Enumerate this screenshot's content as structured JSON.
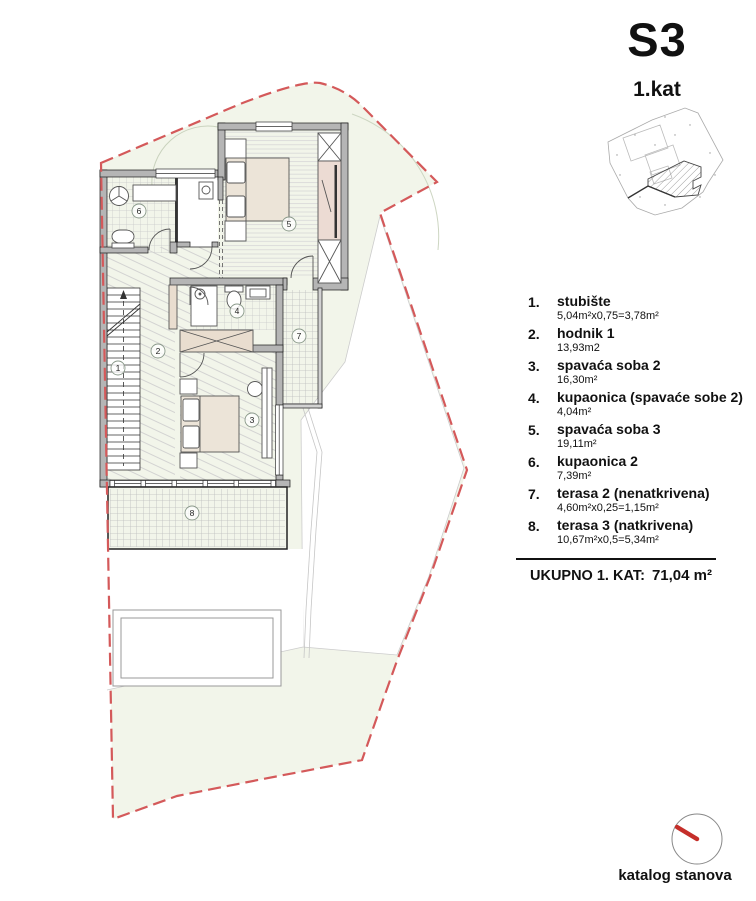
{
  "header": {
    "title": "S3",
    "subtitle": "1.kat"
  },
  "legend": {
    "items": [
      {
        "num": "1.",
        "name": "stubište",
        "area": "5,04m²x0,75=3,78m²"
      },
      {
        "num": "2.",
        "name": "hodnik 1",
        "area": "13,93m2"
      },
      {
        "num": "3.",
        "name": "spavaća soba 2",
        "area": "16,30m²"
      },
      {
        "num": "4.",
        "name": "kupaonica (spavaće sobe 2)",
        "area": "4,04m²"
      },
      {
        "num": "5.",
        "name": "spavaća soba 3",
        "area": "19,11m²"
      },
      {
        "num": "6.",
        "name": "kupaonica 2",
        "area": "7,39m²"
      },
      {
        "num": "7.",
        "name": "terasa 2 (nenatkrivena)",
        "area": "4,60m²x0,25=1,15m²"
      },
      {
        "num": "8.",
        "name": "terasa 3 (natkrivena)",
        "area": "10,67m²x0,5=5,34m²"
      }
    ],
    "total_label": "UKUPNO 1. KAT:",
    "total_value": "71,04 m²"
  },
  "plan": {
    "room_numbers": [
      "1",
      "2",
      "3",
      "4",
      "5",
      "6",
      "7",
      "8"
    ]
  },
  "footer": {
    "compass_label": "katalog stanova"
  },
  "colors": {
    "boundary_red": "#d4595a",
    "lot_green": "#f2f5ea",
    "wall_gray": "#b5b5b5",
    "furniture_beige": "#e9ddcf",
    "wardrobe_pink": "#ecdbd3",
    "compass_needle_red": "#c52f2a"
  }
}
